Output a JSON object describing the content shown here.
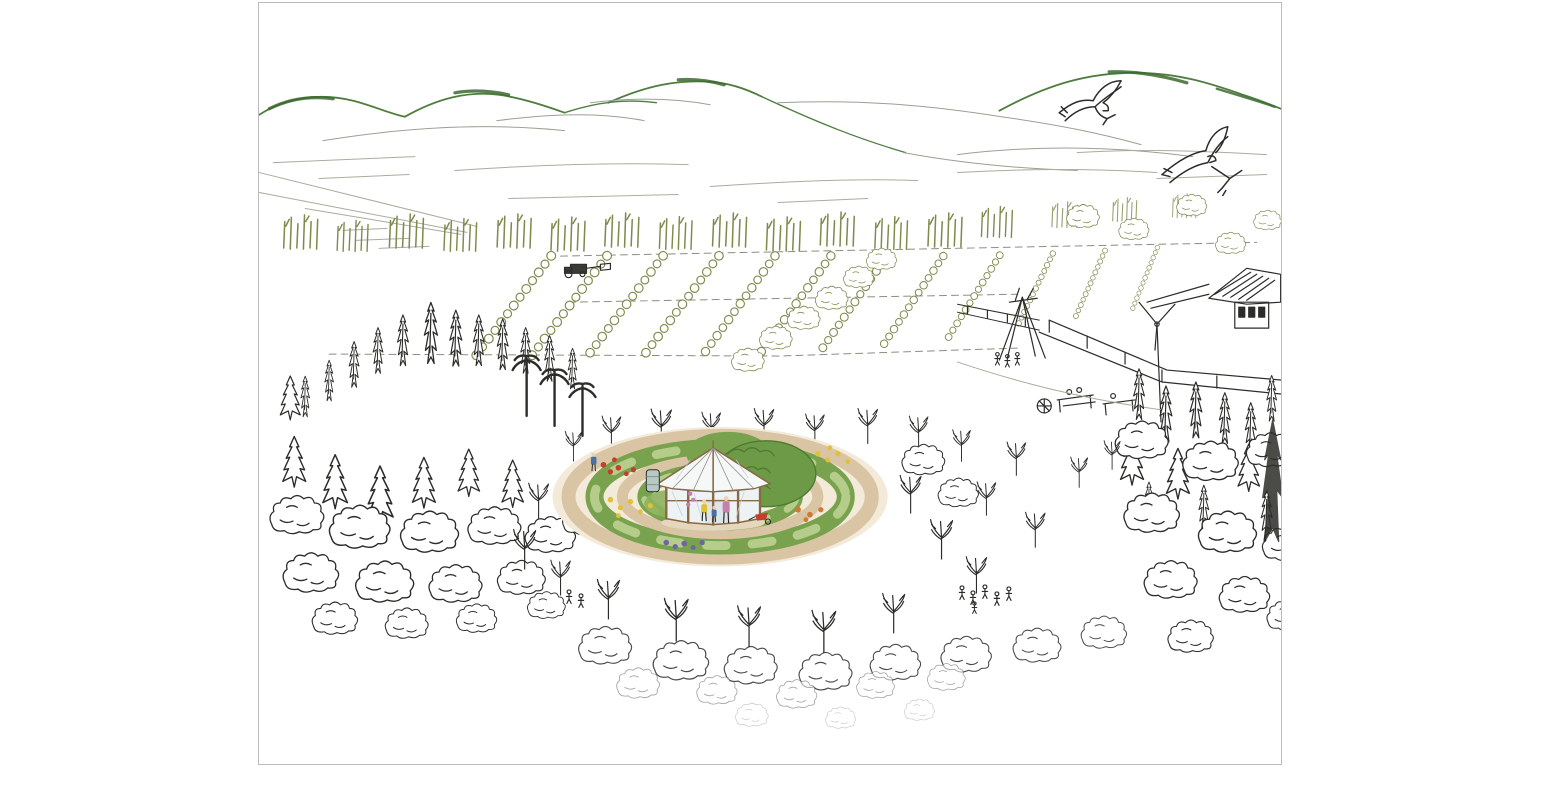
{
  "artwork": {
    "title": "aerial-perspective pen-and-ink sketch of a permaculture farm landscape",
    "style": "hand-drawn line sketch with watercolor highlights on white paper",
    "sky": {
      "bird_count": 2,
      "bird_type": "soaring kites with forked tails"
    },
    "background_elements": [
      "mountain ridges",
      "lake and valley plain",
      "field boundary lines"
    ],
    "midground_elements": [
      "poplar windbreak row",
      "diagonal orchard rows",
      "farm buildings and barn",
      "wind turbine",
      "tipi",
      "picnic tables with people",
      "tractor working the field"
    ],
    "foreground_elements": [
      "dense woodland left",
      "dense woodland right",
      "bare-branched orchard trees",
      "circular mandala garden",
      "glass yurt pavilion",
      "water barrel",
      "red wheelbarrow",
      "small groups of visitors"
    ],
    "garden": {
      "concentric_rings": 5,
      "path_rings": 3,
      "planted_rings": 2,
      "center_structure": "octagonal timber-framed glasshouse yurt"
    }
  },
  "palette": {
    "paper": "#ffffff",
    "frame_border": "#bcbcbc",
    "ink": "#2c2c29",
    "ink_light": "#55554f",
    "ridge_green": "#4e7d3e",
    "ridge_dark": "#3c6a2f",
    "ridge_gray": "#9aa092",
    "plain_gray": "#a8ad9c",
    "olive": "#7d8c4d",
    "path_tan": "#d9c5a4",
    "ground_tint": "#f3ead9",
    "court_tint": "#f6f1e4",
    "bed_green": "#79a24e",
    "bed_green_light": "#b5cc8a",
    "mound_green": "#6d9a47",
    "mound_dark": "#4e7a33",
    "flower_red": "#c63d2c",
    "flower_yellow": "#e0c23a",
    "flower_orange": "#cf7a33",
    "flower_purple": "#6f63a5",
    "flower_pink": "#c77fb0",
    "frame_brown": "#8a6a45",
    "roof_white": "#f6f8f8",
    "roof_shade": "#9b9b94",
    "panel_blue": "#edf2f5",
    "door_shade": "#dce6ea",
    "barrel_gray": "#b7c9c4",
    "cart_red": "#c23f2e",
    "figure_blue": "#4a6fa5",
    "figure_yellow": "#e0c23a",
    "figure_pink": "#c77fb0",
    "skin": "#e8d3b3",
    "tractor_dark": "#3a3a35"
  }
}
